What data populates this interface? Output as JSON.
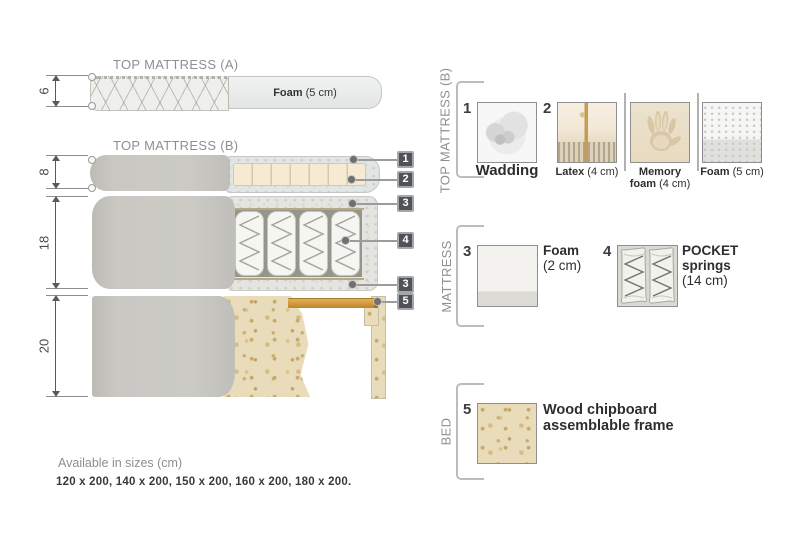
{
  "colors": {
    "callout_box": "#515257",
    "wood_slat": "#d09a3c",
    "text_gray": "#8f8f8f",
    "text_dark": "#2e2e2e"
  },
  "diagram": {
    "top_mattress_a": {
      "title": "TOP MATTRESS (A)",
      "height": "6",
      "foam_name": "Foam",
      "foam_detail": " (5 cm)"
    },
    "top_mattress_b": {
      "title": "TOP MATTRESS (B)",
      "height": "8"
    },
    "mattress": {
      "height": "18"
    },
    "bed": {
      "height": "20"
    },
    "callouts": [
      "1",
      "2",
      "3",
      "4",
      "3",
      "5"
    ]
  },
  "legend": {
    "top_b": {
      "label": "TOP MATTRESS (B)",
      "wadding": {
        "num": "1",
        "name": "Wadding"
      },
      "latex": {
        "num": "2",
        "name": "Latex",
        "detail": " (4 cm)"
      },
      "memory": {
        "name_line1": "Memory",
        "name_line2": "foam",
        "detail": " (4 cm)"
      },
      "foam": {
        "name": "Foam",
        "detail": " (5 cm)"
      }
    },
    "mattress": {
      "label": "MATTRESS",
      "foam": {
        "num": "3",
        "name": "Foam",
        "detail": "(2 cm)"
      },
      "springs": {
        "num": "4",
        "name_line1": "POCKET",
        "name_line2": "springs",
        "detail": "(14 cm)"
      }
    },
    "bed": {
      "label": "BED",
      "chipboard": {
        "num": "5",
        "name_line1": "Wood chipboard",
        "name_line2": "assemblable frame"
      }
    }
  },
  "footer": {
    "title": "Available in sizes (cm)",
    "sizes": "120 x 200, 140 x 200, 150 x 200, 160 x 200, 180 x 200."
  }
}
